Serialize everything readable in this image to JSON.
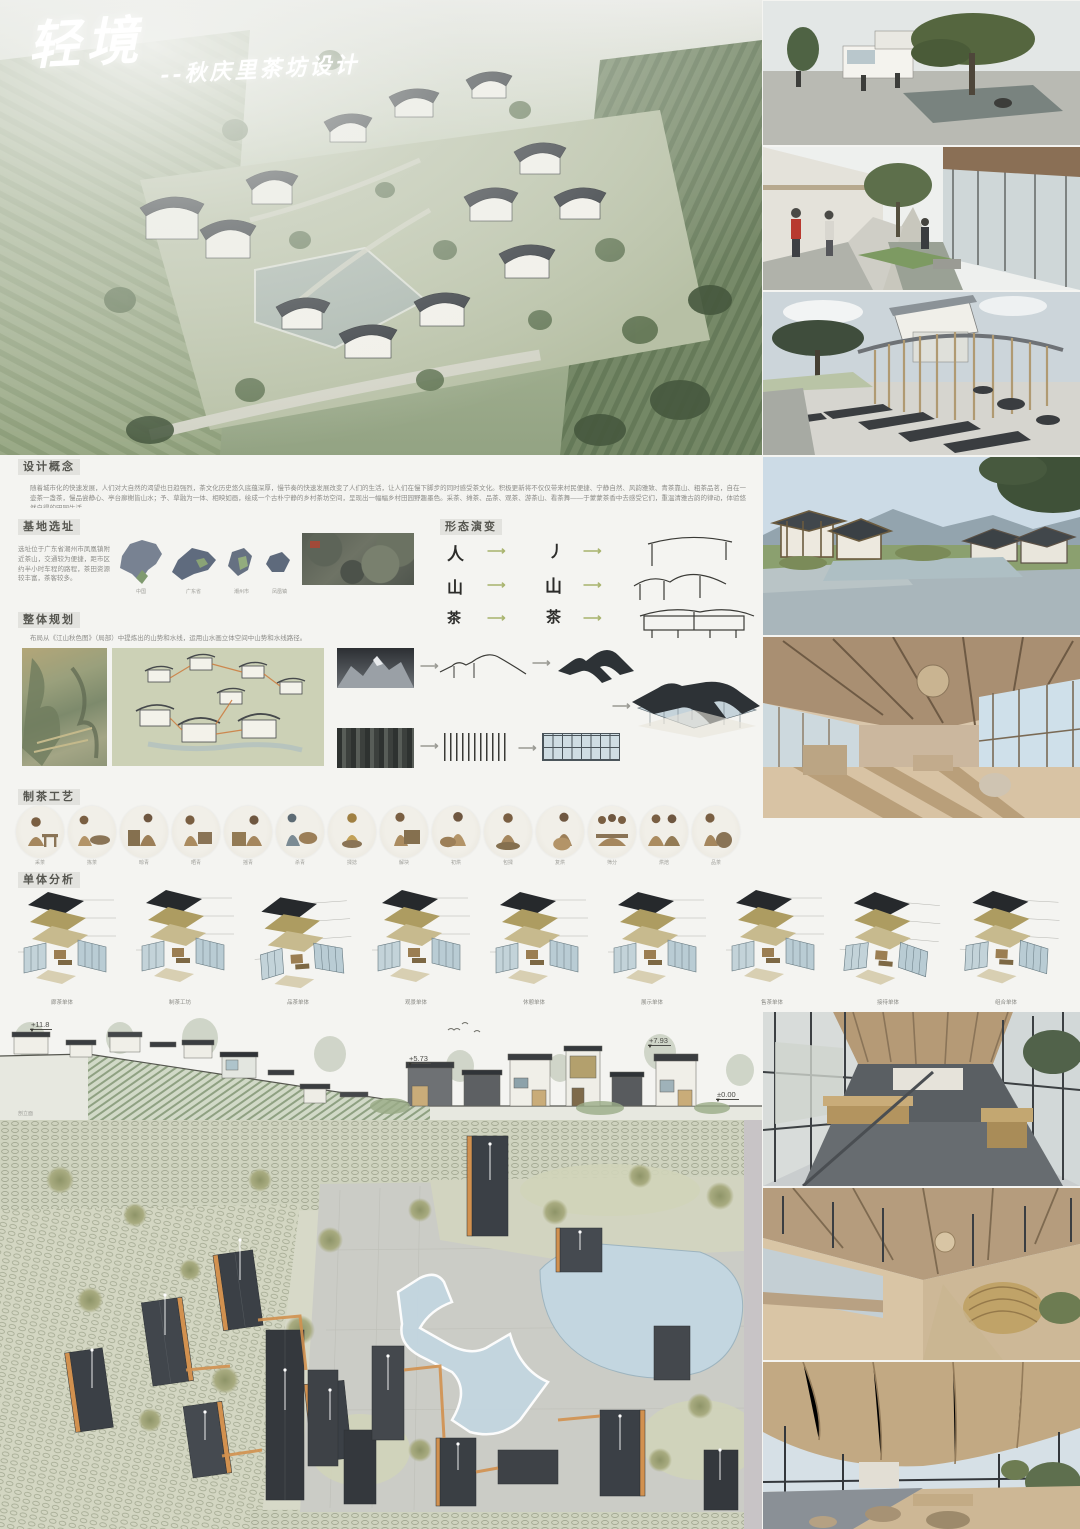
{
  "title": {
    "main": "轻境",
    "sub": "--秋庆里茶坊设计"
  },
  "sections": {
    "concept": {
      "header": "设计概念",
      "body": "随着城市化的快速发展，人们对大自然的渴望也日趋强烈，茶文化历史悠久底蕴深厚，慢节奏的快速发展改变了人们的生活，让人们在慢下脚步的同时感受茶文化。积极更新将不仅仅带来村民便捷、宁静自然、风韵雅致、青茶靠山、粗茶品茗，自在一壶茶一盏茶，慢品尝静心、亭台廊榭皆山水；予、草融为一体、相映如画，绘成一个古朴宁静的乡村茶坊空间，呈现出一幅幅乡村田园野趣墨色。采茶、摊茶、品茶、观茶、游茶山、看茶舞——于蒙蒙茶香中去感受它们，重温清雅古韵的律动，体验悠然自得的田园生活。"
    },
    "site": {
      "header": "基地选址",
      "body": "选址位于广东省潮州市凤凰镇附近茶山，交通较为便捷，距市区约半小时车程的路程，茶田资源较丰富，茶客较多。",
      "map_captions": [
        "中国",
        "广东省",
        "潮州市",
        "凤凰镇"
      ]
    },
    "form": {
      "header": "形态演变",
      "rows": [
        {
          "src": "人",
          "mid": "丿"
        },
        {
          "src": "山",
          "mid": "山"
        },
        {
          "src": "茶",
          "mid": "茶"
        }
      ]
    },
    "planning": {
      "header": "整体规划",
      "body": "布局从《江山秋色图》（局部）中提炼出的山势和水线，运用山水画立体空间中山势和水线路径。"
    },
    "process": {
      "header": "制茶工艺",
      "steps": [
        "采茶",
        "拣茶",
        "晾青",
        "晒青",
        "摇青",
        "杀青",
        "揉捻",
        "解块",
        "初烘",
        "包揉",
        "复烘",
        "筛分",
        "烘焙",
        "品茶"
      ]
    },
    "unit": {
      "header": "单体分析",
      "labels": [
        "廊茶单体",
        "制茶工坊",
        "品茶单体",
        "观景单体",
        "休憩单体",
        "展示单体",
        "售茶单体",
        "接待单体",
        "组合单体"
      ]
    }
  },
  "section_drawing": {
    "label": "剖立面",
    "levels": {
      "l1": "+11.8",
      "l2": "+5.73",
      "l3": "+7.93",
      "l4": "±0.00"
    }
  },
  "colors": {
    "roof_dark": "#33383c",
    "wood_tan": "#c9ac79",
    "glass_blue": "#bcd0da",
    "accent_orange": "#d2914f",
    "field_green": "#9aa886",
    "pond_blue": "#c3d6e0"
  }
}
